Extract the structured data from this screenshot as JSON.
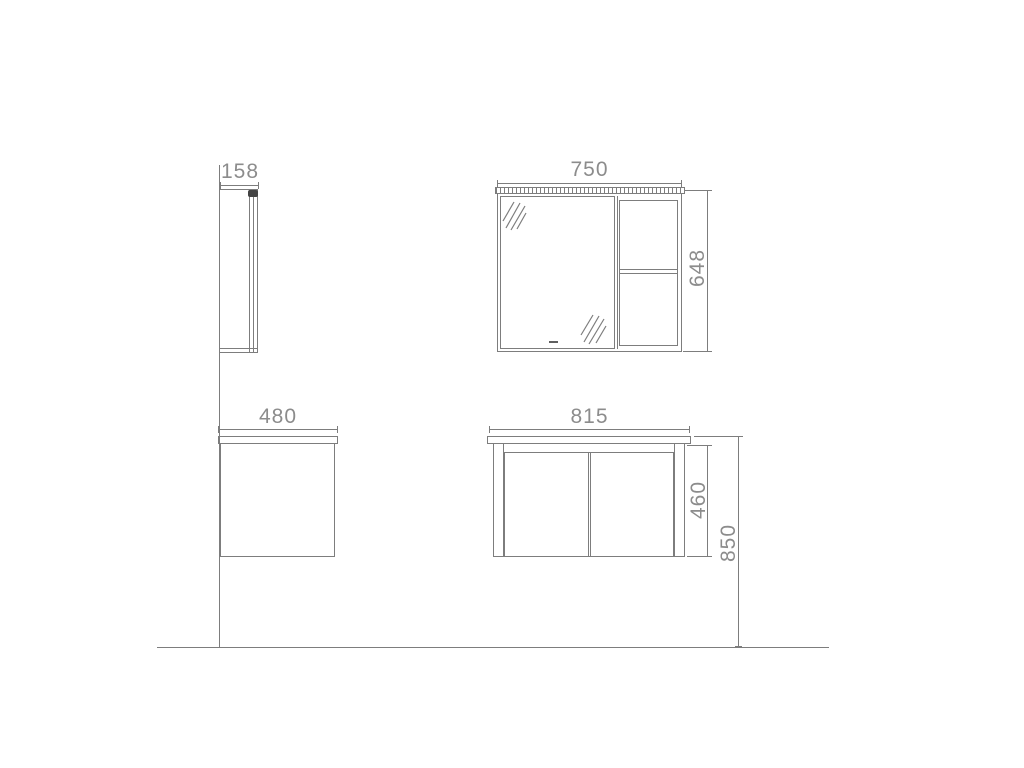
{
  "drawing": {
    "type": "furniture-dimension-diagram",
    "units": "mm",
    "colors": {
      "line": "#7d7d7d",
      "text": "#8c8c8c",
      "dark": "#434343",
      "bg": "#ffffff"
    },
    "icons": {
      "mirror_reflection": "diagonal-hatch-lines",
      "light_fixture": "dark-rounded-block",
      "light_strip": "ticked-bar"
    },
    "views": {
      "mirror_cabinet_side": {
        "depth_label": "158"
      },
      "mirror_cabinet_front": {
        "width_label": "750",
        "height_label": "648"
      },
      "vanity_side": {
        "depth_label": "480"
      },
      "vanity_front": {
        "width_label": "815",
        "body_height_label": "460",
        "total_height_label": "850"
      }
    }
  }
}
